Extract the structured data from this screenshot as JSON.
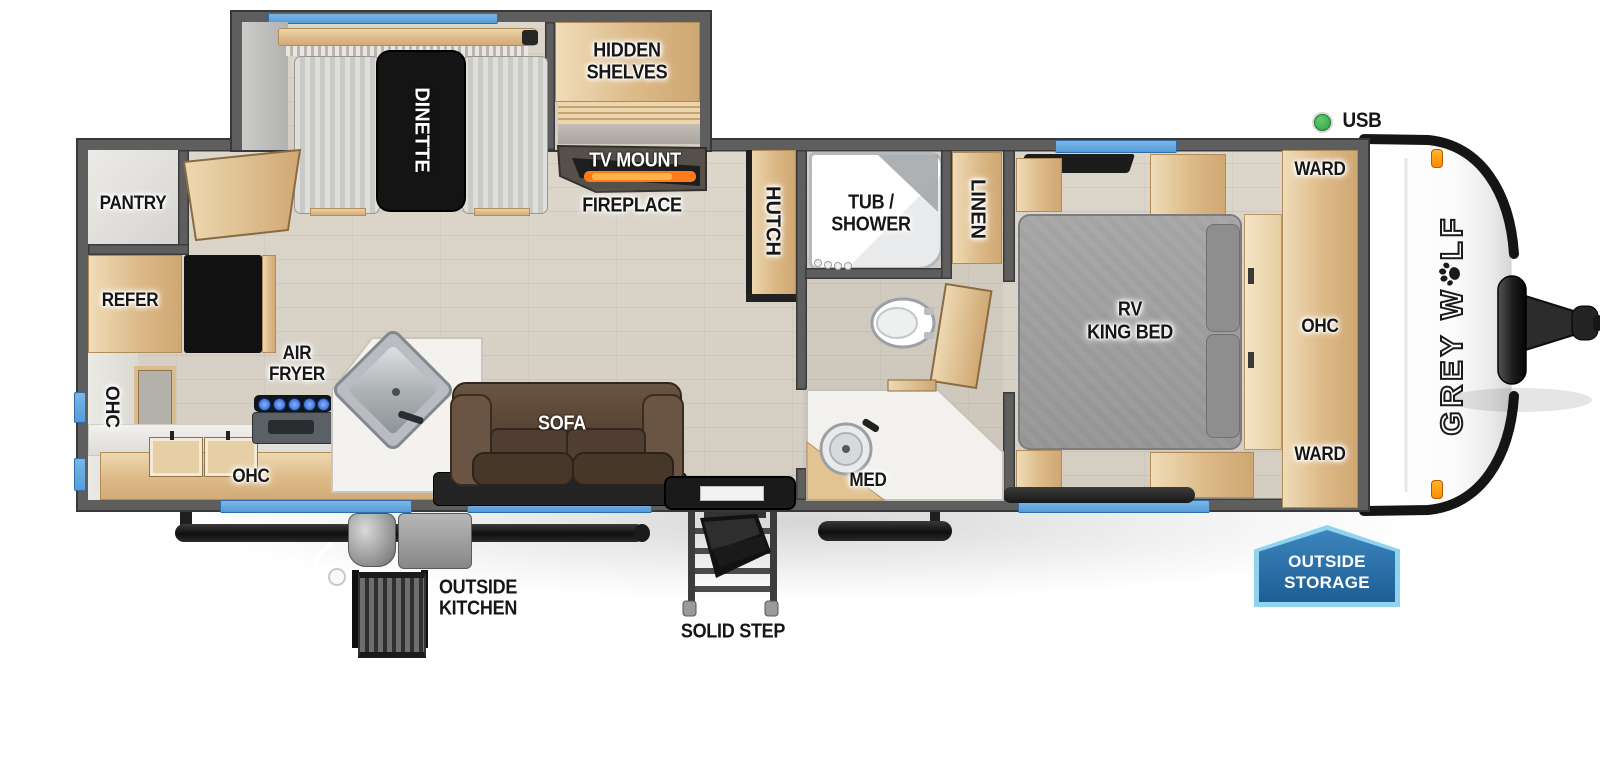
{
  "colors": {
    "wall_gray": "#5e5e5e",
    "window_blue": "#63a9e0",
    "wood_tan": "#ddba88",
    "sofa_brown": "#5b4638",
    "bed_gray": "#9d9d9d",
    "flame_orange": "#ff7a1a",
    "usb_green": "#3bb54a",
    "storage_badge_blue": "#2a6ea6",
    "storage_badge_border": "#8fd3ef",
    "clearance_light_orange": "#ff9d1e"
  },
  "slide_out": {
    "dinette": "DINETTE",
    "hidden_shelves_lines": [
      "HIDDEN",
      "SHELVES"
    ]
  },
  "living_area": {
    "tv_mount": "TV MOUNT",
    "fireplace": "FIREPLACE",
    "hutch": "HUTCH",
    "sofa": "SOFA"
  },
  "kitchen": {
    "pantry": "PANTRY",
    "refer": "REFER",
    "ohc_left": "OHC",
    "air_fryer_lines": [
      "AIR",
      "FRYER"
    ],
    "ohc_bottom": "OHC"
  },
  "bathroom": {
    "tub_shower_lines": [
      "TUB /",
      "SHOWER"
    ],
    "linen": "LINEN",
    "med": "MED"
  },
  "bedroom": {
    "bed_lines": [
      "RV",
      "KING BED"
    ],
    "ward_top": "WARD",
    "ohc": "OHC",
    "ward_bottom": "WARD"
  },
  "callouts": {
    "usb": "USB",
    "outside_kitchen_lines": [
      "OUTSIDE",
      "KITCHEN"
    ],
    "solid_step": "SOLID STEP",
    "outside_storage_lines": [
      "OUTSIDE",
      "STORAGE"
    ]
  },
  "branding": {
    "model_prefix": "GREY W",
    "model_suffix": "LF"
  }
}
